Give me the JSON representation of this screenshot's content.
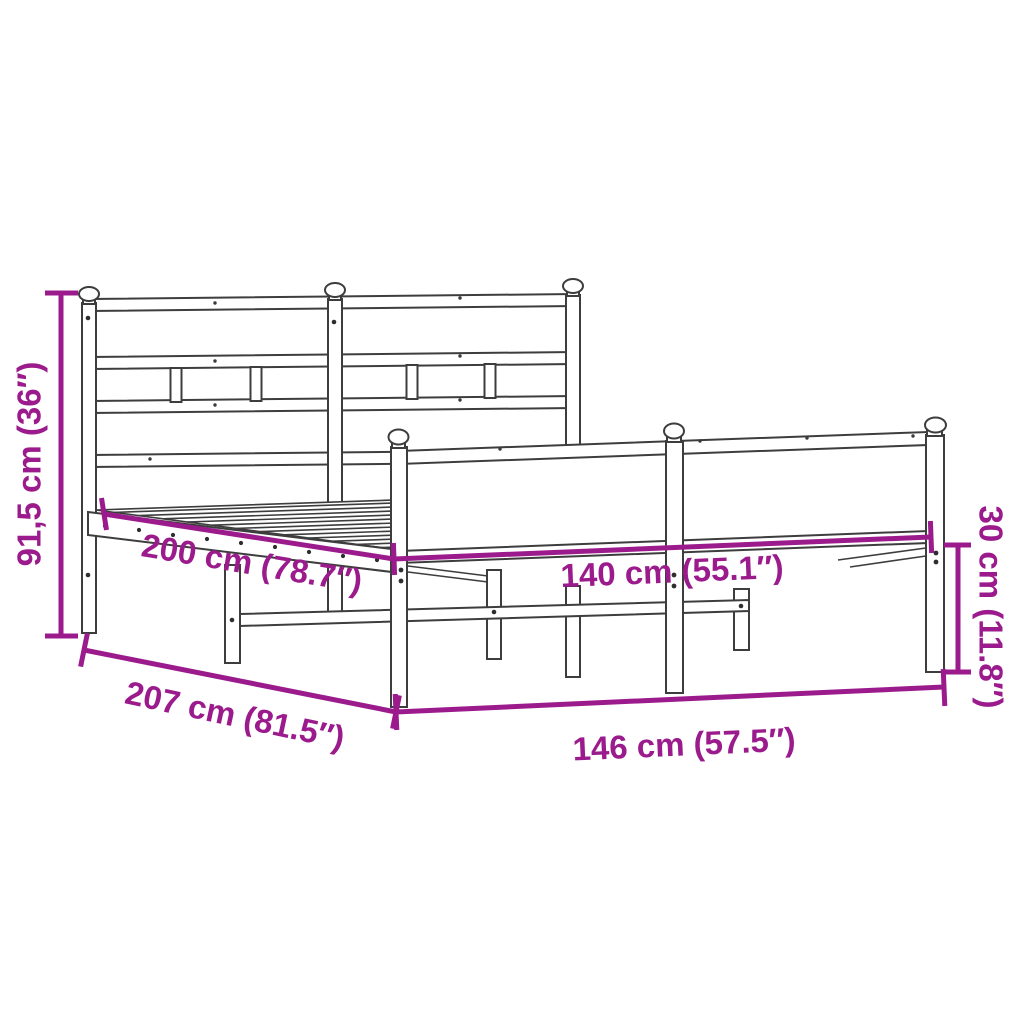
{
  "diagram": {
    "kind": "product-dimension-diagram",
    "subject": "metal bed frame with headboard and footboard",
    "style": {
      "dimension_color": "#9B1B8D",
      "outline_color": "#3d3d3d",
      "background_color": "#ffffff"
    },
    "dimensions": [
      {
        "name": "headboard height",
        "label": "91,5 cm (36″)",
        "value_cm": "91,5",
        "value_inch": "36"
      },
      {
        "name": "inner length",
        "label": "200 cm (78.7″)",
        "value_cm": "200",
        "value_inch": "78.7"
      },
      {
        "name": "inner width",
        "label": "140 cm (55.1″)",
        "value_cm": "140",
        "value_inch": "55.1"
      },
      {
        "name": "outer length",
        "label": "207 cm (81.5″)",
        "value_cm": "207",
        "value_inch": "81.5"
      },
      {
        "name": "outer width",
        "label": "146 cm (57.5″)",
        "value_cm": "146",
        "value_inch": "57.5"
      },
      {
        "name": "footboard height",
        "label": "30 cm (11.8″)",
        "value_cm": "30",
        "value_inch": "11.8"
      }
    ]
  }
}
